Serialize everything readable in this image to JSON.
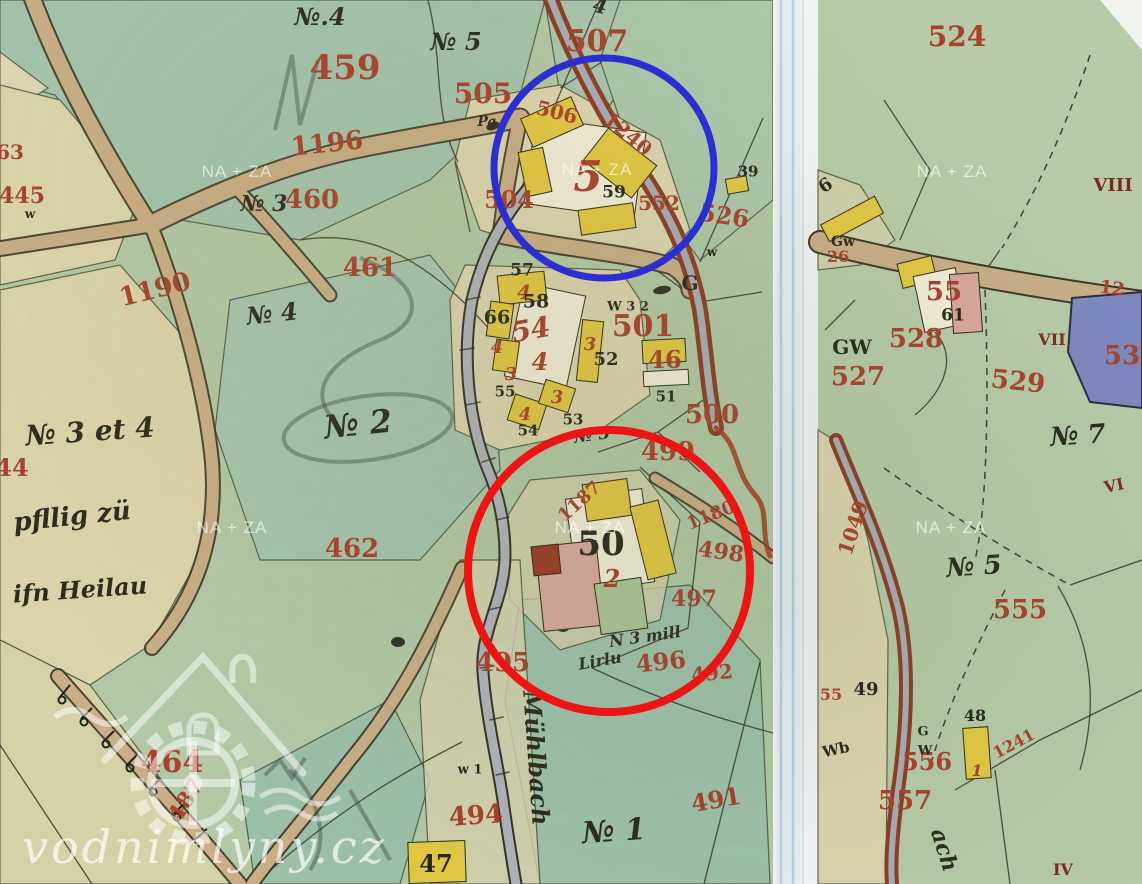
{
  "canvas": {
    "width": 1142,
    "height": 884
  },
  "watermark": {
    "text": "NA + ZA",
    "positions": [
      [
        237,
        172
      ],
      [
        597,
        170
      ],
      [
        952,
        172
      ],
      [
        232,
        528
      ],
      [
        590,
        528
      ],
      [
        951,
        528
      ]
    ]
  },
  "logo": {
    "text": "vodnimlyny.cz"
  },
  "annotations": {
    "blue_circle": {
      "cx": 604,
      "cy": 168,
      "r": 110,
      "color": "#2b2fd0",
      "width": 7
    },
    "red_circle": {
      "cx": 609,
      "cy": 571,
      "r": 141,
      "color": "#ec1515",
      "width": 8
    }
  },
  "palette": {
    "Y": "#e3c843",
    "W": "#f3eed9",
    "P": "#d9a89c",
    "R": "#993826",
    "G": "#a9c598"
  },
  "labels": [
    {
      "t": "459",
      "x": 345,
      "y": 68,
      "s": 34,
      "c": "red"
    },
    {
      "t": "507",
      "x": 597,
      "y": 42,
      "s": 30,
      "c": "red"
    },
    {
      "t": "505",
      "x": 483,
      "y": 94,
      "s": 28,
      "c": "red"
    },
    {
      "t": "1196",
      "x": 327,
      "y": 144,
      "s": 26,
      "c": "red",
      "r": -6
    },
    {
      "t": "460",
      "x": 312,
      "y": 200,
      "s": 26,
      "c": "red"
    },
    {
      "t": "461",
      "x": 370,
      "y": 268,
      "s": 26,
      "c": "red"
    },
    {
      "t": "1190",
      "x": 155,
      "y": 290,
      "s": 26,
      "c": "red",
      "r": -14
    },
    {
      "t": "63",
      "x": 10,
      "y": 152,
      "s": 20,
      "c": "red"
    },
    {
      "t": "445",
      "x": 22,
      "y": 196,
      "s": 22,
      "c": "red"
    },
    {
      "t": "44",
      "x": 12,
      "y": 468,
      "s": 24,
      "c": "red"
    },
    {
      "t": "462",
      "x": 352,
      "y": 549,
      "s": 26,
      "c": "red"
    },
    {
      "t": "506",
      "x": 557,
      "y": 112,
      "s": 20,
      "c": "red",
      "r": 14
    },
    {
      "t": "1240",
      "x": 628,
      "y": 134,
      "s": 20,
      "c": "red",
      "r": 40
    },
    {
      "t": "504",
      "x": 509,
      "y": 200,
      "s": 24,
      "c": "red"
    },
    {
      "t": "5",
      "x": 588,
      "y": 177,
      "s": 42,
      "c": "redi"
    },
    {
      "t": "552",
      "x": 659,
      "y": 203,
      "s": 20,
      "c": "red"
    },
    {
      "t": "526",
      "x": 724,
      "y": 216,
      "s": 24,
      "c": "red",
      "r": 8
    },
    {
      "t": "501",
      "x": 643,
      "y": 327,
      "s": 30,
      "c": "red"
    },
    {
      "t": "54",
      "x": 531,
      "y": 330,
      "s": 28,
      "c": "redi",
      "r": -10
    },
    {
      "t": "4",
      "x": 540,
      "y": 362,
      "s": 24,
      "c": "redi"
    },
    {
      "t": "4",
      "x": 524,
      "y": 292,
      "s": 20,
      "c": "redi"
    },
    {
      "t": "4",
      "x": 497,
      "y": 348,
      "s": 18,
      "c": "redi"
    },
    {
      "t": "3",
      "x": 511,
      "y": 375,
      "s": 18,
      "c": "redi"
    },
    {
      "t": "4",
      "x": 525,
      "y": 415,
      "s": 18,
      "c": "redi"
    },
    {
      "t": "3",
      "x": 557,
      "y": 398,
      "s": 18,
      "c": "redi"
    },
    {
      "t": "3",
      "x": 590,
      "y": 345,
      "s": 18,
      "c": "redi"
    },
    {
      "t": "46",
      "x": 665,
      "y": 360,
      "s": 24,
      "c": "red"
    },
    {
      "t": "500",
      "x": 712,
      "y": 415,
      "s": 26,
      "c": "red"
    },
    {
      "t": "499",
      "x": 668,
      "y": 452,
      "s": 26,
      "c": "red"
    },
    {
      "t": "1187",
      "x": 580,
      "y": 502,
      "s": 18,
      "c": "red",
      "r": -42
    },
    {
      "t": "1180",
      "x": 711,
      "y": 516,
      "s": 18,
      "c": "red",
      "r": -22
    },
    {
      "t": "498",
      "x": 721,
      "y": 552,
      "s": 22,
      "c": "red",
      "r": 8
    },
    {
      "t": "497",
      "x": 694,
      "y": 599,
      "s": 22,
      "c": "red"
    },
    {
      "t": "496",
      "x": 661,
      "y": 662,
      "s": 24,
      "c": "red",
      "r": -6
    },
    {
      "t": "492",
      "x": 712,
      "y": 673,
      "s": 20,
      "c": "red",
      "r": -6
    },
    {
      "t": "495",
      "x": 503,
      "y": 663,
      "s": 26,
      "c": "red"
    },
    {
      "t": "494",
      "x": 476,
      "y": 816,
      "s": 26,
      "c": "red",
      "r": -4
    },
    {
      "t": "491",
      "x": 716,
      "y": 800,
      "s": 24,
      "c": "red",
      "r": -10
    },
    {
      "t": "487",
      "x": 186,
      "y": 800,
      "s": 22,
      "c": "red",
      "r": -58
    },
    {
      "t": "464",
      "x": 172,
      "y": 763,
      "s": 30,
      "c": "red"
    },
    {
      "t": "2",
      "x": 612,
      "y": 579,
      "s": 24,
      "c": "redi"
    },
    {
      "t": "524",
      "x": 957,
      "y": 37,
      "s": 28,
      "c": "red"
    },
    {
      "t": "26",
      "x": 838,
      "y": 257,
      "s": 16,
      "c": "red"
    },
    {
      "t": "55",
      "x": 944,
      "y": 292,
      "s": 26,
      "c": "red"
    },
    {
      "t": "528",
      "x": 916,
      "y": 339,
      "s": 26,
      "c": "red"
    },
    {
      "t": "527",
      "x": 858,
      "y": 377,
      "s": 26,
      "c": "red"
    },
    {
      "t": "529",
      "x": 1018,
      "y": 382,
      "s": 26,
      "c": "red",
      "r": 6
    },
    {
      "t": "53",
      "x": 1122,
      "y": 356,
      "s": 26,
      "c": "red"
    },
    {
      "t": "12",
      "x": 1112,
      "y": 289,
      "s": 18,
      "c": "red",
      "r": 8
    },
    {
      "t": "1049",
      "x": 853,
      "y": 528,
      "s": 20,
      "c": "red",
      "r": -72
    },
    {
      "t": "555",
      "x": 1020,
      "y": 610,
      "s": 26,
      "c": "red"
    },
    {
      "t": "55",
      "x": 831,
      "y": 695,
      "s": 16,
      "c": "red"
    },
    {
      "t": "556",
      "x": 927,
      "y": 762,
      "s": 24,
      "c": "red"
    },
    {
      "t": "1",
      "x": 977,
      "y": 771,
      "s": 16,
      "c": "redi"
    },
    {
      "t": "1241",
      "x": 1014,
      "y": 744,
      "s": 16,
      "c": "red",
      "r": -28
    },
    {
      "t": "557",
      "x": 905,
      "y": 801,
      "s": 26,
      "c": "red"
    },
    {
      "t": "VIII",
      "x": 1113,
      "y": 186,
      "s": 18,
      "c": "darkred"
    },
    {
      "t": "VII",
      "x": 1052,
      "y": 340,
      "s": 16,
      "c": "darkred"
    },
    {
      "t": "VI",
      "x": 1114,
      "y": 486,
      "s": 16,
      "c": "darkred",
      "r": -12
    },
    {
      "t": "IV",
      "x": 1063,
      "y": 870,
      "s": 16,
      "c": "darkred"
    },
    {
      "t": "57",
      "x": 522,
      "y": 271,
      "s": 17,
      "c": "ink"
    },
    {
      "t": "58",
      "x": 536,
      "y": 302,
      "s": 19,
      "c": "ink"
    },
    {
      "t": "66",
      "x": 497,
      "y": 318,
      "s": 19,
      "c": "ink"
    },
    {
      "t": "52",
      "x": 606,
      "y": 360,
      "s": 18,
      "c": "ink"
    },
    {
      "t": "55",
      "x": 505,
      "y": 392,
      "s": 15,
      "c": "ink"
    },
    {
      "t": "54",
      "x": 528,
      "y": 431,
      "s": 15,
      "c": "ink"
    },
    {
      "t": "53",
      "x": 573,
      "y": 420,
      "s": 15,
      "c": "ink"
    },
    {
      "t": "59",
      "x": 614,
      "y": 193,
      "s": 17,
      "c": "ink"
    },
    {
      "t": "51",
      "x": 666,
      "y": 397,
      "s": 15,
      "c": "ink"
    },
    {
      "t": "50",
      "x": 601,
      "y": 544,
      "s": 34,
      "c": "ink"
    },
    {
      "t": "47",
      "x": 436,
      "y": 864,
      "s": 24,
      "c": "ink"
    },
    {
      "t": "G",
      "x": 690,
      "y": 283,
      "s": 20,
      "c": "ink"
    },
    {
      "t": "W 3 2",
      "x": 628,
      "y": 307,
      "s": 13,
      "c": "ink"
    },
    {
      "t": "w",
      "x": 30,
      "y": 214,
      "s": 12,
      "c": "ink"
    },
    {
      "t": "w",
      "x": 712,
      "y": 252,
      "s": 12,
      "c": "ink"
    },
    {
      "t": "w 1",
      "x": 470,
      "y": 770,
      "s": 13,
      "c": "ink"
    },
    {
      "t": "39",
      "x": 748,
      "y": 172,
      "s": 15,
      "c": "ink"
    },
    {
      "t": "Pa",
      "x": 487,
      "y": 122,
      "s": 14,
      "c": "script"
    },
    {
      "t": "6",
      "x": 826,
      "y": 186,
      "s": 18,
      "c": "ink",
      "r": -35
    },
    {
      "t": "Gw",
      "x": 843,
      "y": 242,
      "s": 14,
      "c": "ink"
    },
    {
      "t": "GW",
      "x": 852,
      "y": 347,
      "s": 20,
      "c": "ink"
    },
    {
      "t": "61",
      "x": 953,
      "y": 316,
      "s": 17,
      "c": "ink"
    },
    {
      "t": "49",
      "x": 866,
      "y": 690,
      "s": 18,
      "c": "ink"
    },
    {
      "t": "48",
      "x": 975,
      "y": 716,
      "s": 16,
      "c": "ink"
    },
    {
      "t": "G",
      "x": 923,
      "y": 732,
      "s": 13,
      "c": "ink"
    },
    {
      "t": "W",
      "x": 925,
      "y": 751,
      "s": 13,
      "c": "ink"
    },
    {
      "t": "Wb",
      "x": 836,
      "y": 750,
      "s": 15,
      "c": "ink",
      "r": -12
    },
    {
      "t": "№.4",
      "x": 320,
      "y": 17,
      "s": 24,
      "c": "script"
    },
    {
      "t": "4",
      "x": 600,
      "y": 6,
      "s": 20,
      "c": "script",
      "r": 12
    },
    {
      "t": "№ 5",
      "x": 456,
      "y": 42,
      "s": 24,
      "c": "script"
    },
    {
      "t": "№ 3",
      "x": 264,
      "y": 204,
      "s": 22,
      "c": "script"
    },
    {
      "t": "№ 4",
      "x": 272,
      "y": 314,
      "s": 24,
      "c": "script",
      "r": -6
    },
    {
      "t": "№ 2",
      "x": 358,
      "y": 424,
      "s": 32,
      "c": "script",
      "r": -6
    },
    {
      "t": "№ 3 et 4",
      "x": 90,
      "y": 432,
      "s": 28,
      "c": "script",
      "r": -4
    },
    {
      "t": "pfllig zü",
      "x": 72,
      "y": 517,
      "s": 26,
      "c": "script",
      "r": -6
    },
    {
      "t": "ifn Heilau",
      "x": 80,
      "y": 590,
      "s": 24,
      "c": "script",
      "r": -4
    },
    {
      "t": "№ 3",
      "x": 592,
      "y": 436,
      "s": 17,
      "c": "script",
      "r": -8
    },
    {
      "t": "N 3 mill",
      "x": 645,
      "y": 637,
      "s": 16,
      "c": "script",
      "r": -8
    },
    {
      "t": "Lirlu",
      "x": 600,
      "y": 661,
      "s": 16,
      "c": "script",
      "r": -10
    },
    {
      "t": "№ 1",
      "x": 614,
      "y": 832,
      "s": 30,
      "c": "script",
      "r": -4
    },
    {
      "t": "Mühlbach",
      "x": 536,
      "y": 758,
      "s": 24,
      "c": "script",
      "r": 86
    },
    {
      "t": "№ 7",
      "x": 1078,
      "y": 436,
      "s": 26,
      "c": "script",
      "r": -4
    },
    {
      "t": "№ 5",
      "x": 974,
      "y": 567,
      "s": 26,
      "c": "script",
      "r": -4
    },
    {
      "t": "ach",
      "x": 944,
      "y": 850,
      "s": 22,
      "c": "script",
      "r": 72
    }
  ],
  "buildings": [
    {
      "x": 585,
      "y": 168,
      "w": 112,
      "h": 88,
      "rot": 8,
      "f": "W"
    },
    {
      "x": 552,
      "y": 122,
      "w": 56,
      "h": 32,
      "rot": -24,
      "f": "Y"
    },
    {
      "x": 620,
      "y": 163,
      "w": 62,
      "h": 42,
      "rot": 38,
      "f": "Y"
    },
    {
      "x": 535,
      "y": 172,
      "w": 26,
      "h": 46,
      "rot": -12,
      "f": "Y"
    },
    {
      "x": 607,
      "y": 219,
      "w": 56,
      "h": 26,
      "rot": -8,
      "f": "Y"
    },
    {
      "x": 545,
      "y": 336,
      "w": 64,
      "h": 96,
      "rot": 12,
      "f": "W"
    },
    {
      "x": 522,
      "y": 288,
      "w": 48,
      "h": 30,
      "rot": -6,
      "f": "Y"
    },
    {
      "x": 590,
      "y": 351,
      "w": 22,
      "h": 62,
      "rot": 6,
      "f": "Y"
    },
    {
      "x": 500,
      "y": 320,
      "w": 24,
      "h": 36,
      "rot": 8,
      "f": "Y"
    },
    {
      "x": 506,
      "y": 356,
      "w": 24,
      "h": 32,
      "rot": 8,
      "f": "Y"
    },
    {
      "x": 527,
      "y": 412,
      "w": 34,
      "h": 28,
      "rot": 18,
      "f": "Y"
    },
    {
      "x": 557,
      "y": 396,
      "w": 32,
      "h": 26,
      "rot": 18,
      "f": "Y"
    },
    {
      "x": 664,
      "y": 351,
      "w": 44,
      "h": 24,
      "rot": -3,
      "f": "Y"
    },
    {
      "x": 666,
      "y": 378,
      "w": 46,
      "h": 16,
      "rot": -3,
      "f": "W"
    },
    {
      "x": 610,
      "y": 540,
      "w": 78,
      "h": 95,
      "rot": -8,
      "f": "W"
    },
    {
      "x": 607,
      "y": 500,
      "w": 46,
      "h": 38,
      "rot": -8,
      "f": "Y"
    },
    {
      "x": 653,
      "y": 540,
      "w": 30,
      "h": 76,
      "rot": -14,
      "f": "Y"
    },
    {
      "x": 570,
      "y": 586,
      "w": 62,
      "h": 86,
      "rot": -6,
      "f": "P"
    },
    {
      "x": 546,
      "y": 560,
      "w": 28,
      "h": 30,
      "rot": -6,
      "f": "R"
    },
    {
      "x": 621,
      "y": 606,
      "w": 48,
      "h": 52,
      "rot": -8,
      "f": "G"
    },
    {
      "x": 437,
      "y": 862,
      "w": 58,
      "h": 42,
      "rot": -2,
      "f": "Y"
    },
    {
      "x": 737,
      "y": 185,
      "w": 22,
      "h": 16,
      "rot": -10,
      "f": "Y"
    },
    {
      "x": 852,
      "y": 219,
      "w": 62,
      "h": 20,
      "rot": -28,
      "f": "Y"
    },
    {
      "x": 917,
      "y": 272,
      "w": 36,
      "h": 26,
      "rot": -14,
      "f": "Y"
    },
    {
      "x": 940,
      "y": 300,
      "w": 44,
      "h": 58,
      "rot": -12,
      "f": "W"
    },
    {
      "x": 966,
      "y": 303,
      "w": 30,
      "h": 60,
      "rot": -4,
      "f": "P"
    },
    {
      "x": 977,
      "y": 753,
      "w": 26,
      "h": 52,
      "rot": -4,
      "f": "Y"
    }
  ]
}
